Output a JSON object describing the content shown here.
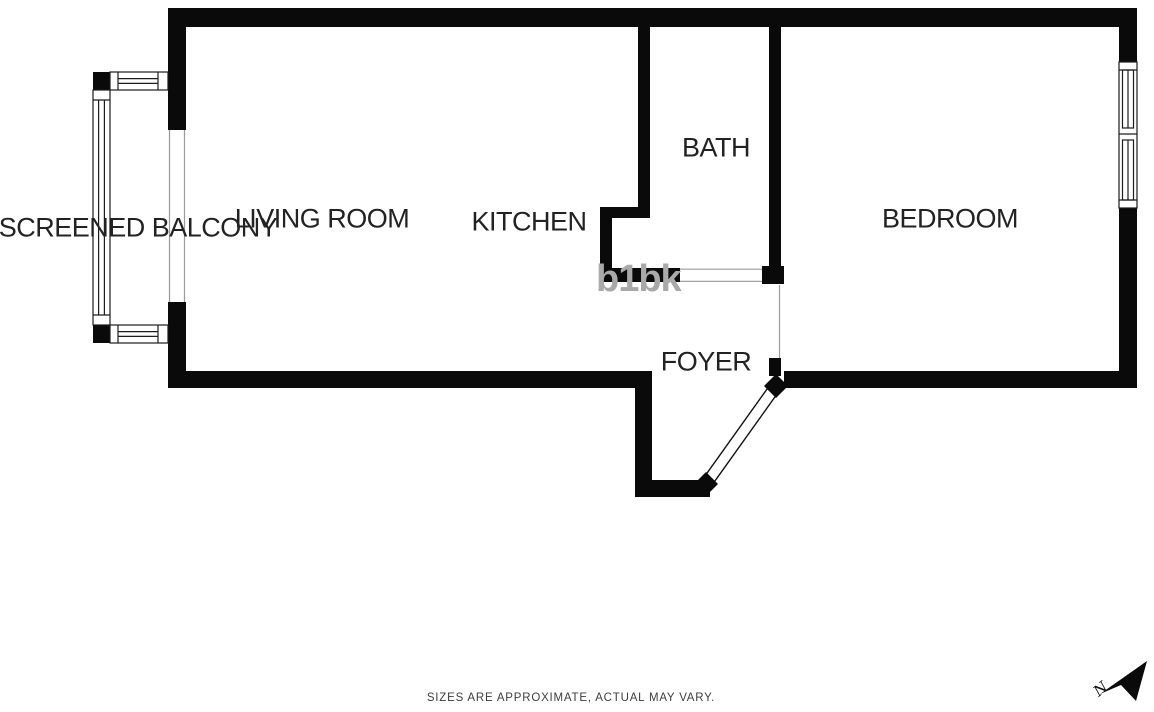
{
  "plan": {
    "title": "one-bedroom apartment floor plan",
    "rooms": [
      {
        "id": "screened-balcony",
        "label": "SCREENED BALCONY"
      },
      {
        "id": "living-room",
        "label": "LIVING ROOM"
      },
      {
        "id": "kitchen",
        "label": "KITCHEN"
      },
      {
        "id": "bath",
        "label": "BATH"
      },
      {
        "id": "bedroom",
        "label": "BEDROOM"
      },
      {
        "id": "foyer",
        "label": "FOYER"
      }
    ],
    "features": [
      "balcony-screen-windows",
      "bedroom-double-hung-window",
      "entry-door-open-45deg",
      "bath-cased-opening",
      "bedroom-cased-opening",
      "balcony-sliding-opening"
    ]
  },
  "watermark": {
    "text": "b1bk"
  },
  "compass": {
    "icon": "north-arrow",
    "label": "N"
  },
  "footer": {
    "disclaimer": "SIZES ARE APPROXIMATE, ACTUAL MAY VARY."
  },
  "colors": {
    "background": "#ffffff",
    "wall": "#0a0a0a",
    "label_text": "#222222",
    "thin_line": "#9a9a9a",
    "watermark": "#a9a9a9",
    "disclaimer_text": "#3d3d3d"
  }
}
